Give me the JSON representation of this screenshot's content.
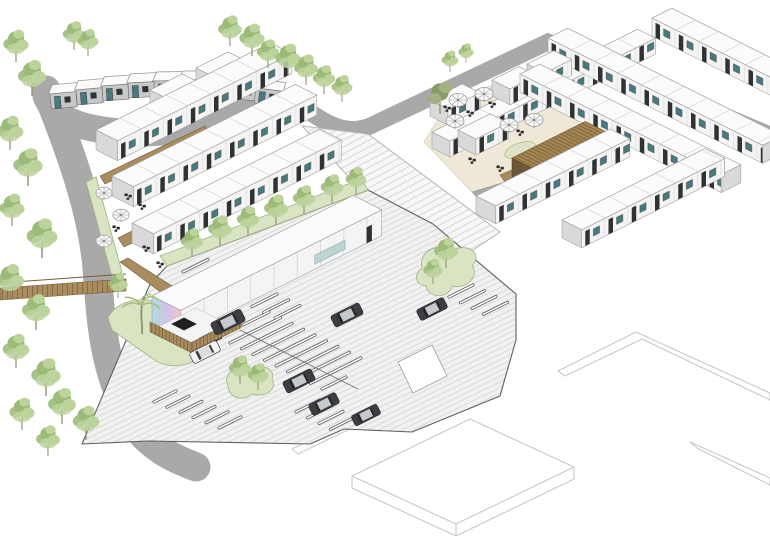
{
  "title": "Isometric site-plan rendering — modular housing community with courtyards and parking lot",
  "scene": {
    "background": "#ffffff",
    "palette": {
      "line": "#3a3a3a",
      "faint": "#c9c9c9",
      "roadEdge": "#a9a9a9",
      "roadBase": "#f7f7f7",
      "hatchLine": "#cfcfcf",
      "meshLine": "#b9b9b9",
      "lotBase": "#f1f1f1",
      "lotHatch": "#d5d5d5",
      "lotEdge": "#606060",
      "stripe": "#ffffff",
      "stripeEdge": "#4a4a4a",
      "roof": "#fbfbfb",
      "roofEdge": "#9a9a9a",
      "roofSeam": "#cccccc",
      "wallFront": "#f4f4f4",
      "wallShade": "#d9d9d9",
      "wallDark": "#2f3133",
      "glassTeal": "#477a7e",
      "rowhouseWall": "#c8c8c8",
      "wood": "#a98c5f",
      "woodDark": "#7a5c38",
      "containerFront": "#8a6b42",
      "containerRoof": "#a5854f",
      "containerSide": "#6e5638",
      "lawn": "#d9e4c2",
      "lawnEdge": "#9fb483",
      "tree1": "#9cbb79",
      "tree2": "#bcd49c",
      "treeTrunk": "#8f8f72",
      "olive1": "#8a9b6a",
      "olive2": "#a3b183",
      "palmGreen": "#a8bd7e",
      "carDark": "#3e3e42",
      "carTop": "#c6c9cd",
      "carGlass": "#23262a",
      "carWhite": "#f2f2f2",
      "carWhiteTop": "#dcdcdc",
      "umbrella": "#fbfbfb",
      "umbrellaRib": "#9a9a9a",
      "furniture": "#2a2a2a",
      "muralA": "#aedde0",
      "muralB": "#cfc3e6",
      "muralC": "#f2c4d8",
      "paving": "#a9a9a9",
      "cream": "#efe8d6"
    },
    "west_cluster": {
      "unit_rows": 3,
      "single_units": 2,
      "community_building_with_mural": true,
      "fenced_patio_canopies": 2,
      "umbrellas": 3,
      "timber_decks": 4,
      "footbridge": true,
      "palm_trees": 1
    },
    "east_cluster": {
      "unit_rows": 7,
      "single_units": 4,
      "timber_clad_community_building": true,
      "courtyard_umbrellas": 5,
      "courtyard_trees": 3
    },
    "row_houses": {
      "units": 9
    },
    "parking": {
      "cars_dark": 6,
      "cars_white": 1,
      "stall_groups": 6,
      "landscape_islands": 2,
      "tree_strip_trees": 7
    },
    "roads": {
      "hatched_loop": true,
      "crosshatched_boulevard": true
    },
    "existing_buildings_outlined": 4,
    "trees_total_approx": 38
  }
}
